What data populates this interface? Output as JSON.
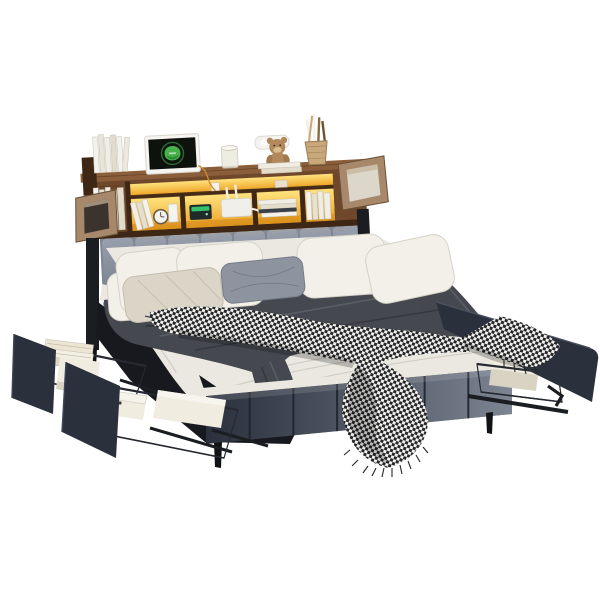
{
  "scene": {
    "description": "Product photo: upholstered platform bed with rustic wood bookcase headboard, LED-lit shelf compartments, glass end doors, and pull-out under-bed storage drawers with wire baskets, shown on a plain white background",
    "objects": [
      "bookcase headboard",
      "LED shelf lighting",
      "monitor with green logo",
      "stacks of books",
      "teddy bear",
      "brush pot",
      "glass cup",
      "wall sconce",
      "alarm clock",
      "wifi router",
      "mini speaker",
      "open glass cabinet doors",
      "channel-tufted headboard",
      "white pillows",
      "gray accent pillow",
      "quilted greige pillow",
      "dark gray duvet",
      "houndstooth throw blanket",
      "upholstered footboard",
      "left storage drawers",
      "right storage drawer",
      "wire baskets",
      "white storage boxes",
      "black metal legs"
    ]
  },
  "colors": {
    "background": "#ffffff",
    "wood": "#6f472b",
    "wood_light": "#8a5e3a",
    "wood_dark": "#3f2715",
    "door_wood": "#a8886a",
    "glass": "#3b342e",
    "led_bright": "#ffcf4a",
    "led_deep": "#e79c1e",
    "fabric_headboard": "#7f8694",
    "fabric_drawer": "#2b303d",
    "footboard_light": "#828b99",
    "sheet": "#ebe8e1",
    "sheet_shadow": "#c9c4ba",
    "duvet": "#45494f",
    "duvet_dark": "#2b2f35",
    "duvet_light": "#686e77",
    "pillow_white": "#f2f0e9",
    "pillow_gray": "#8e949f",
    "pillow_greige": "#dbd5c7",
    "throw_white": "#f2f0ea",
    "throw_black": "#24262b",
    "box_white": "#f0ecdf",
    "box_shade": "#d9d3c4",
    "wire": "#26292f",
    "metal": "#1a1d22",
    "monitor_bezel": "#f6f5f2",
    "monitor_screen": "#0d120d",
    "logo_green": "#46b14b",
    "teddy": "#b1895c"
  }
}
